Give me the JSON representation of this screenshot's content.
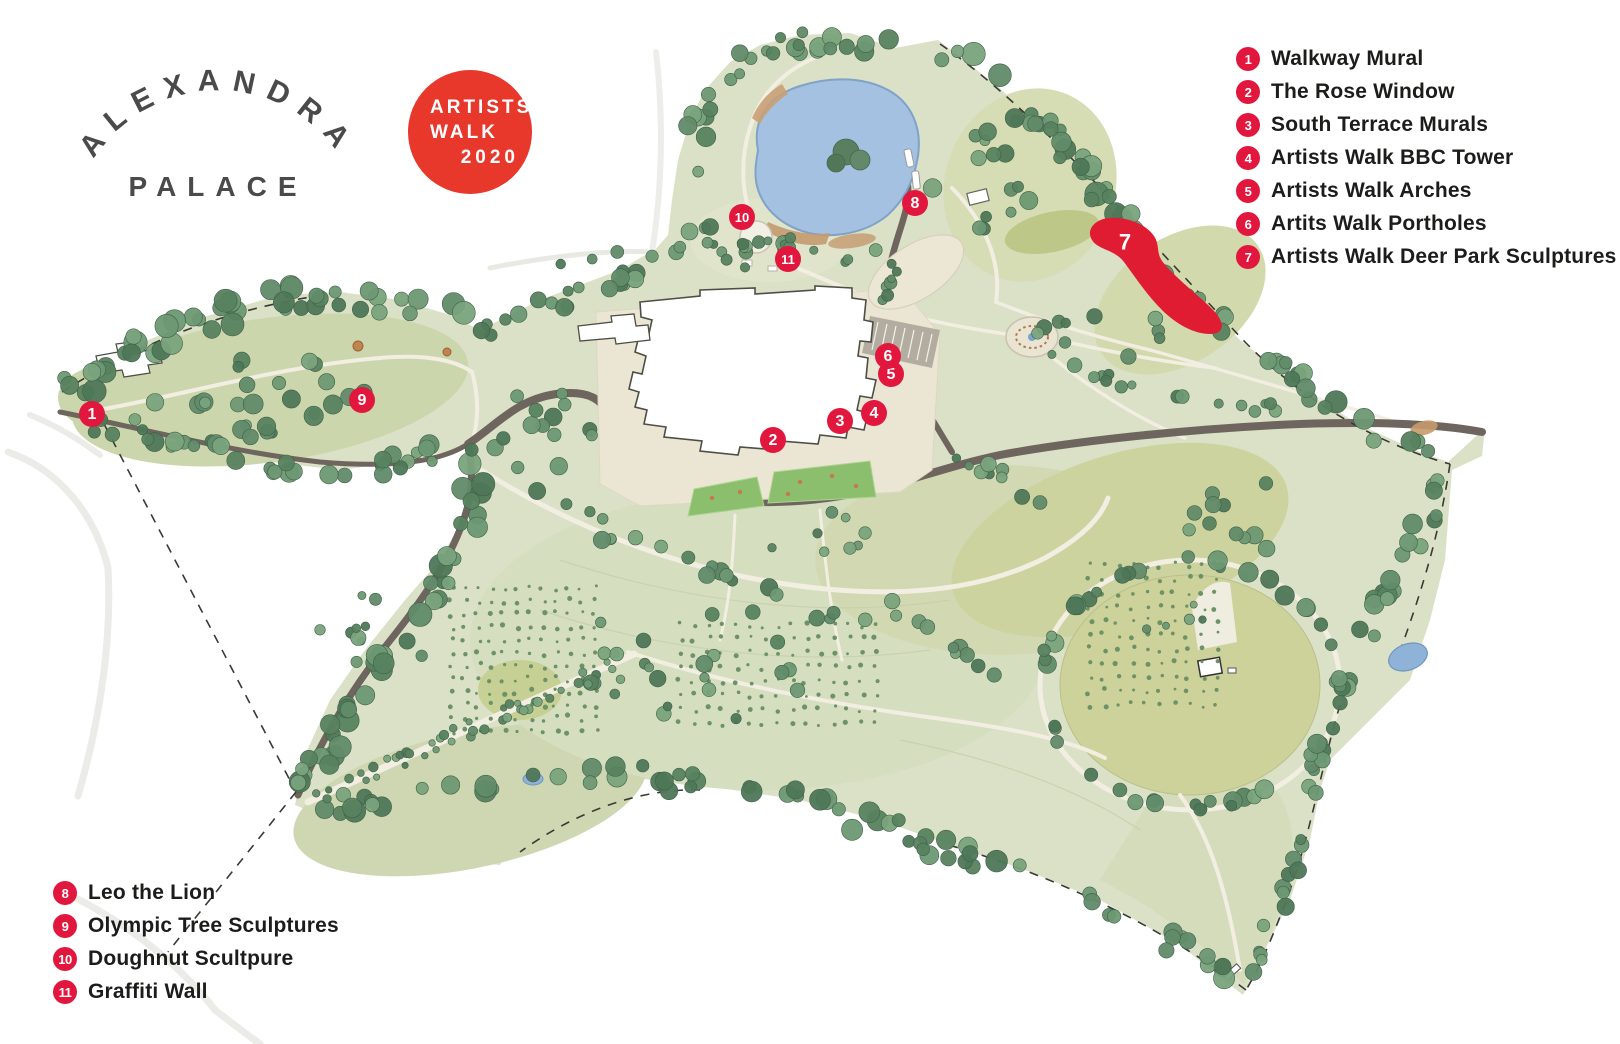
{
  "logo": {
    "line1": "ALEXANDRA",
    "line2": "PALACE"
  },
  "badge": {
    "line1": "ARTISTS",
    "line2": "WALK",
    "line3": "2020"
  },
  "legend_top": [
    {
      "num": "1",
      "label": "Walkway Mural"
    },
    {
      "num": "2",
      "label": "The Rose Window"
    },
    {
      "num": "3",
      "label": "South Terrace Murals"
    },
    {
      "num": "4",
      "label": "Artists Walk BBC Tower"
    },
    {
      "num": "5",
      "label": "Artists Walk Arches"
    },
    {
      "num": "6",
      "label": "Artits Walk Portholes"
    },
    {
      "num": "7",
      "label": "Artists Walk Deer Park Sculptures"
    }
  ],
  "legend_bottom": [
    {
      "num": "8",
      "label": "Leo the Lion"
    },
    {
      "num": "9",
      "label": "Olympic Tree Sculptures"
    },
    {
      "num": "10",
      "label": "Doughnut Scultpure"
    },
    {
      "num": "11",
      "label": "Graffiti Wall"
    }
  ],
  "markers": [
    {
      "num": "1",
      "x": 92,
      "y": 414
    },
    {
      "num": "2",
      "x": 773,
      "y": 440
    },
    {
      "num": "3",
      "x": 840,
      "y": 421
    },
    {
      "num": "4",
      "x": 874,
      "y": 413
    },
    {
      "num": "5",
      "x": 891,
      "y": 374
    },
    {
      "num": "6",
      "x": 888,
      "y": 356
    },
    {
      "num": "8",
      "x": 915,
      "y": 203
    },
    {
      "num": "9",
      "x": 362,
      "y": 400
    },
    {
      "num": "10",
      "x": 742,
      "y": 217
    },
    {
      "num": "11",
      "x": 788,
      "y": 259
    }
  ],
  "deer": {
    "label": "7",
    "x": 1125,
    "y": 242
  },
  "colors": {
    "accent_red": "#e2173d",
    "badge_red": "#e8382b",
    "deer_red": "#e01c33",
    "logo_gray": "#4a4a4b",
    "text_dark": "#1c1c1a",
    "park_green": "#dbe1c6",
    "tree_green": "#5f8a67",
    "lake_blue": "#a4c1e1",
    "road_gray": "#6e665e",
    "path_cream": "#f2eee1"
  }
}
